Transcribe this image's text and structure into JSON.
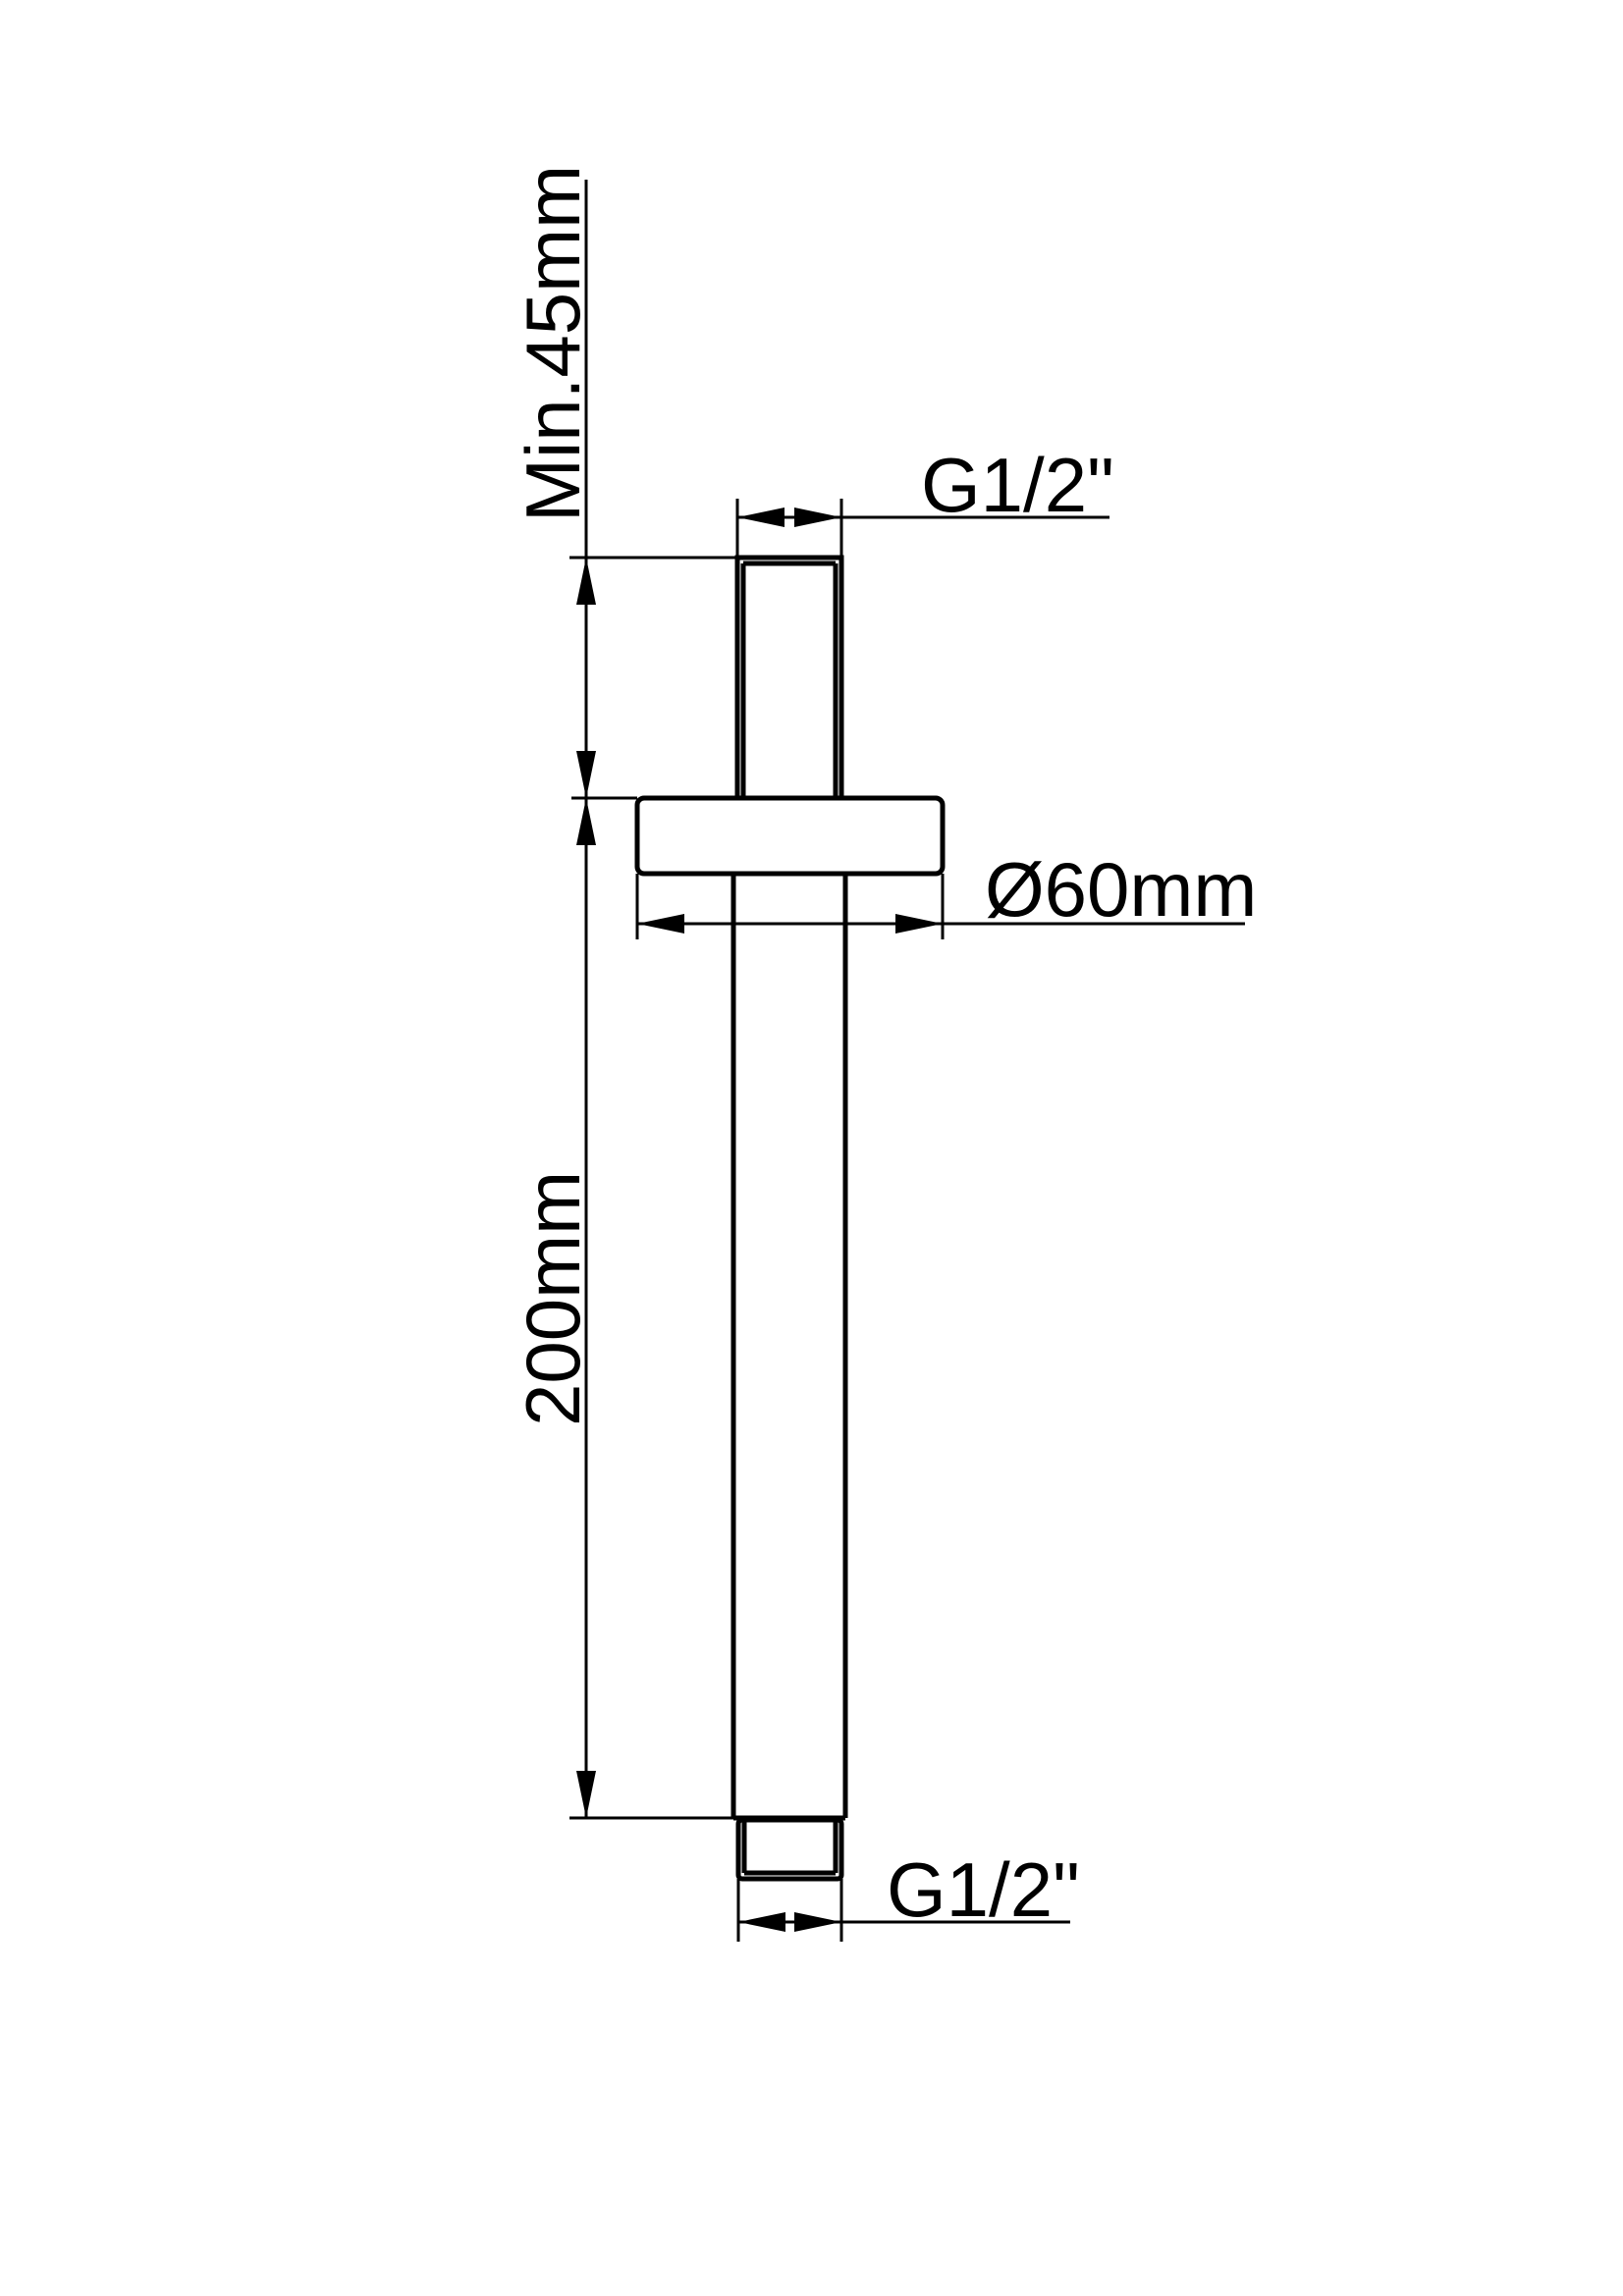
{
  "drawing": {
    "type": "technical-dimension-drawing",
    "subject": "ceiling-mounted shower arm, side elevation",
    "background_color": "#ffffff",
    "line_color": "#000000",
    "labels": {
      "min_ceiling_depth": "Min.45mm",
      "top_thread_size": "G1/2\"",
      "flange_diameter": "Ø60mm",
      "arm_length": "200mm",
      "bottom_thread_size": "G1/2\""
    }
  }
}
